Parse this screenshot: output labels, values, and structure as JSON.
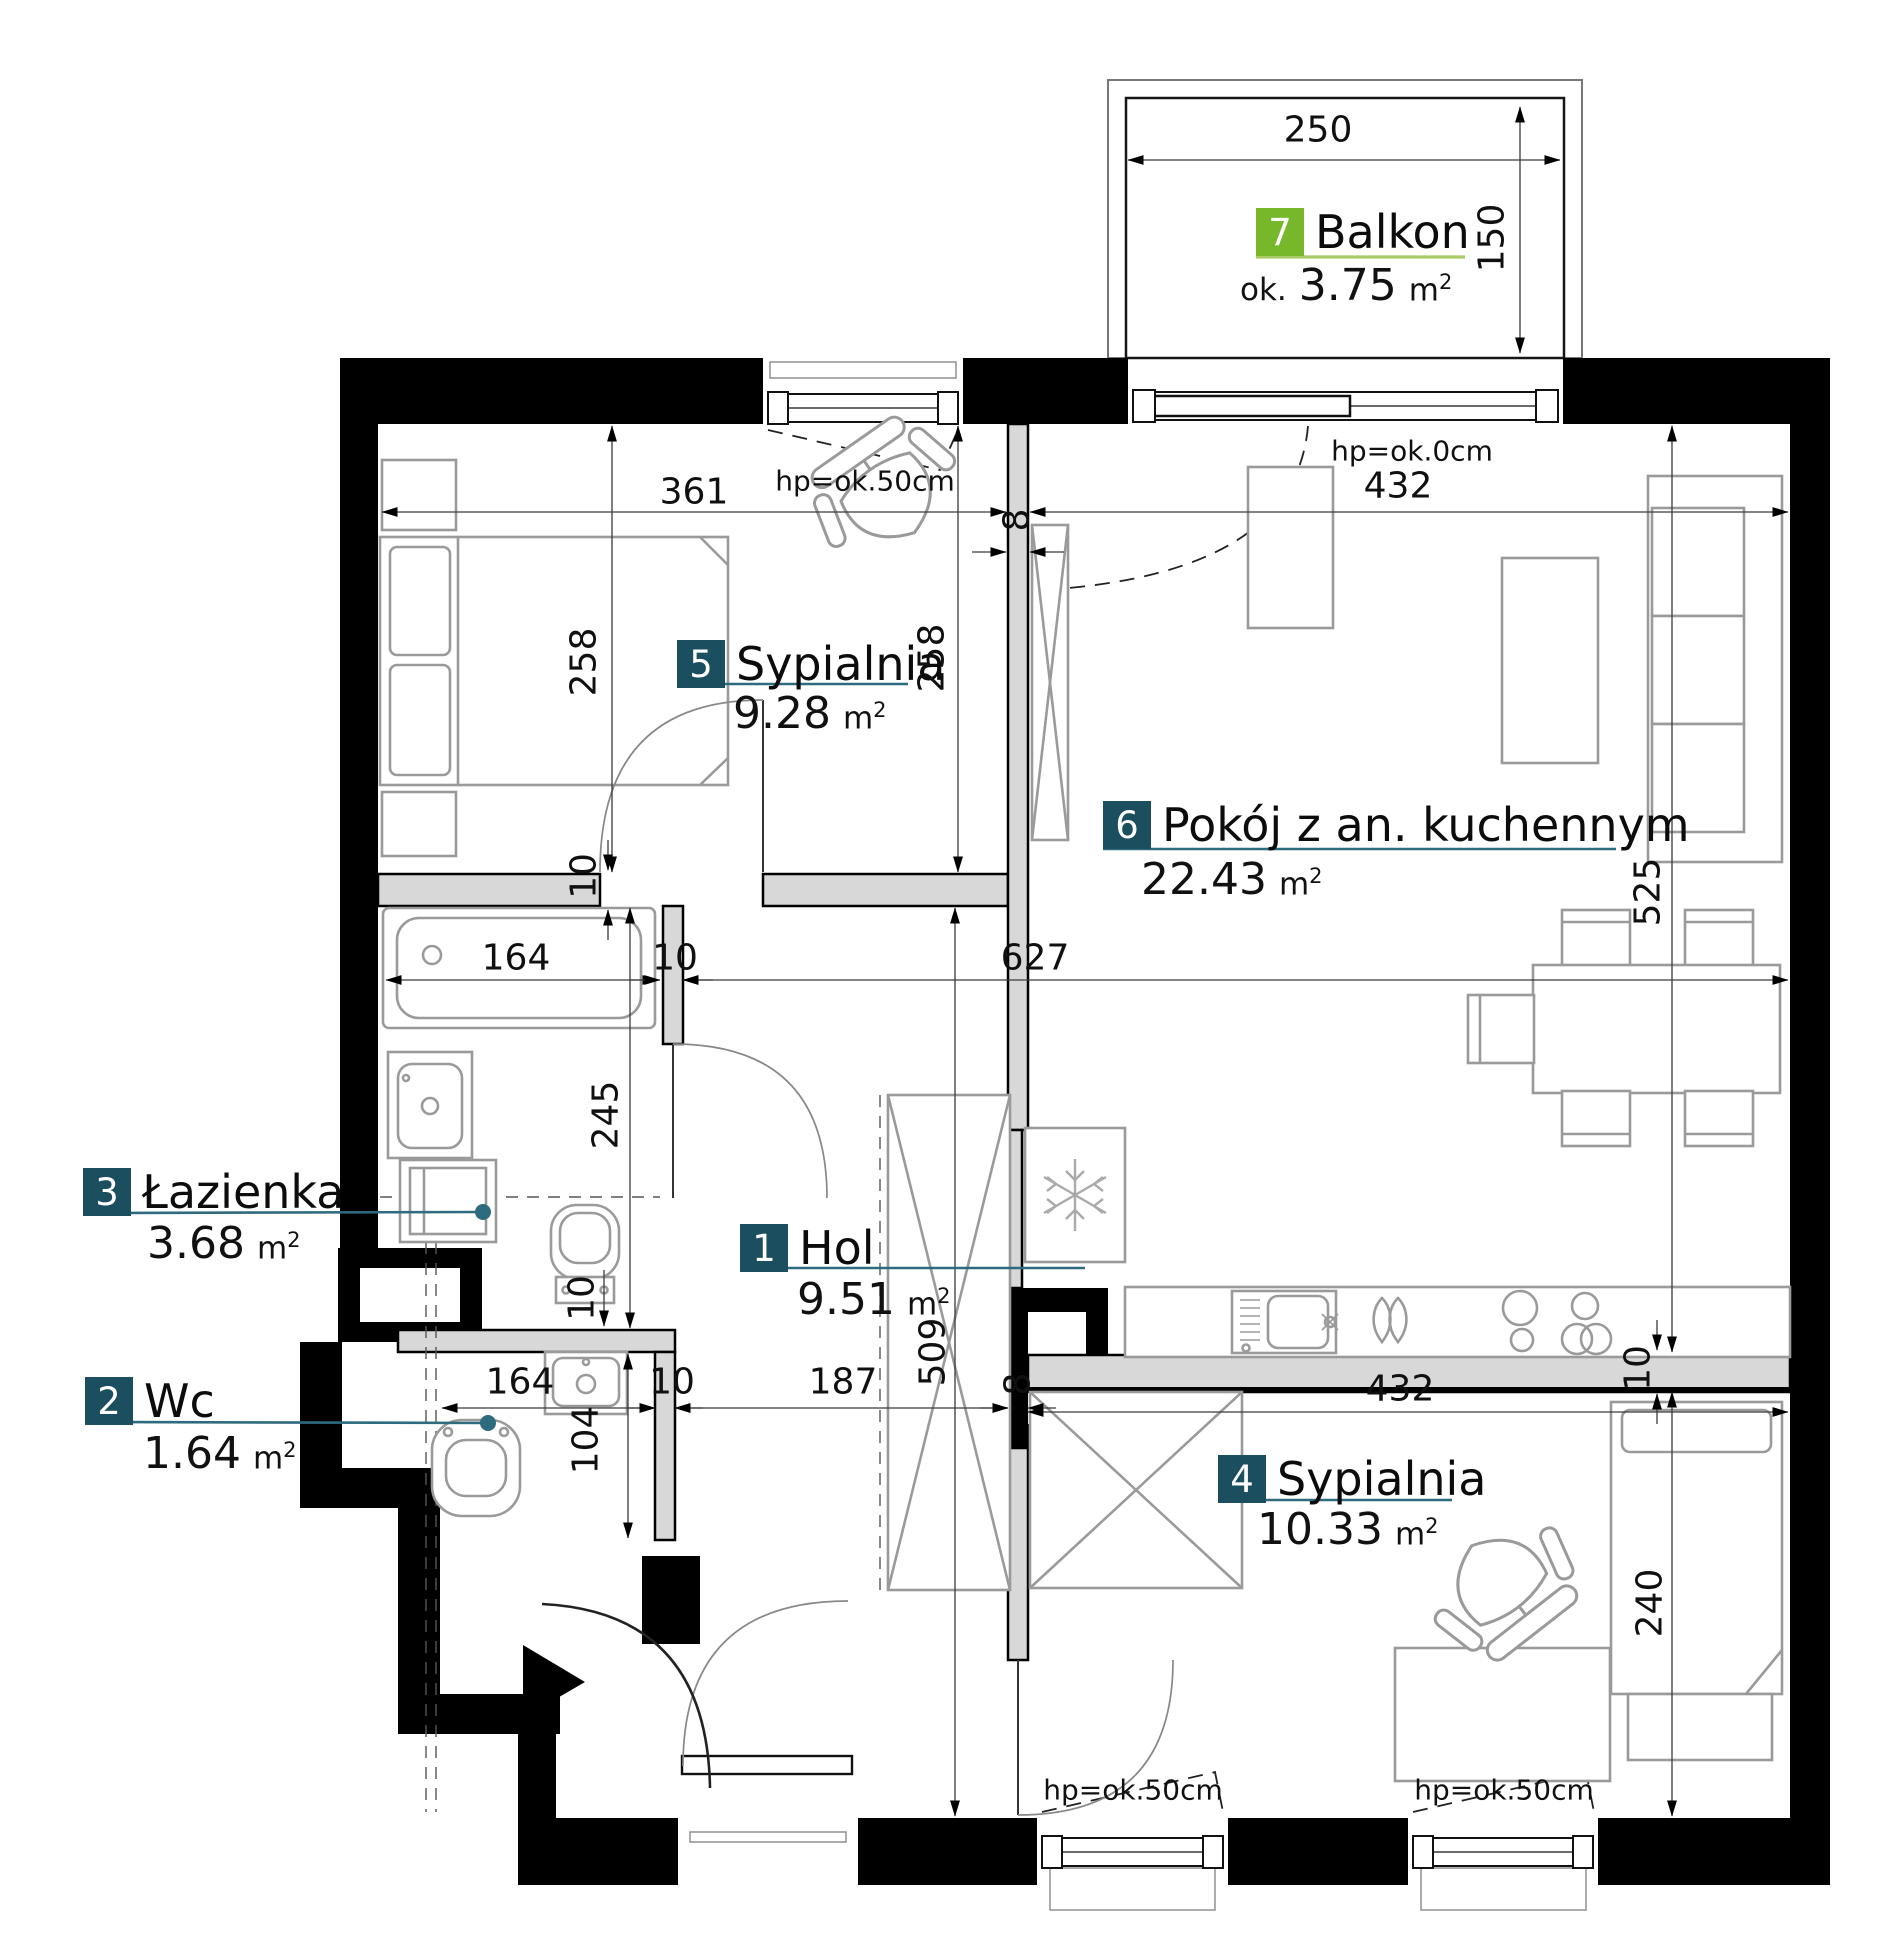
{
  "drawing": {
    "type": "apartment floor plan",
    "language": "pl"
  },
  "units": {
    "base": "m",
    "sup": "2"
  },
  "rooms": [
    {
      "num": "7",
      "name": "Balkon",
      "prefix": "ok.",
      "area": "3.75",
      "accent": "green"
    },
    {
      "num": "5",
      "name": "Sypialnia",
      "area": "9.28",
      "accent": "teal"
    },
    {
      "num": "6",
      "name": "Pokój z an. kuchennym",
      "area": "22.43",
      "accent": "teal"
    },
    {
      "num": "1",
      "name": "Hol",
      "area": "9.51",
      "accent": "teal"
    },
    {
      "num": "3",
      "name": "Łazienka",
      "area": "3.68",
      "accent": "teal"
    },
    {
      "num": "2",
      "name": "Wc",
      "area": "1.64",
      "accent": "teal"
    },
    {
      "num": "4",
      "name": "Sypialnia",
      "area": "10.33",
      "accent": "teal"
    }
  ],
  "dims": {
    "d250": "250",
    "d150": "150",
    "d361": "361",
    "d432_top": "432",
    "d8_top": "8",
    "d258_l": "258",
    "d258_r": "258",
    "d164_bath": "164",
    "d10_bath": "10",
    "d627": "627",
    "d10_wall_s5": "10",
    "d10_wall_p4": "10",
    "d245": "245",
    "d525": "525",
    "d509": "509",
    "d164_wc": "164",
    "d10_wc": "10",
    "d104": "104",
    "d187": "187",
    "d8_mid": "8",
    "d432_bottom": "432",
    "d240": "240",
    "d10_kitchen": "10"
  },
  "window_labels": {
    "top_left": "hp=ok.50cm",
    "top_right": "hp=ok.0cm",
    "bottom_left": "hp=ok.50cm",
    "bottom_right": "hp=ok.50cm"
  },
  "icons": {
    "entrance_arrow": "entrance-direction-triangle",
    "snowflake": "refrigerator-snowflake"
  },
  "colors": {
    "teal": "#1b4e5f",
    "green": "#76b82a",
    "green_light": "#a9cc66",
    "leader": "#2e6b7e",
    "wall": "#000000",
    "partition": "#d8d8d8"
  }
}
